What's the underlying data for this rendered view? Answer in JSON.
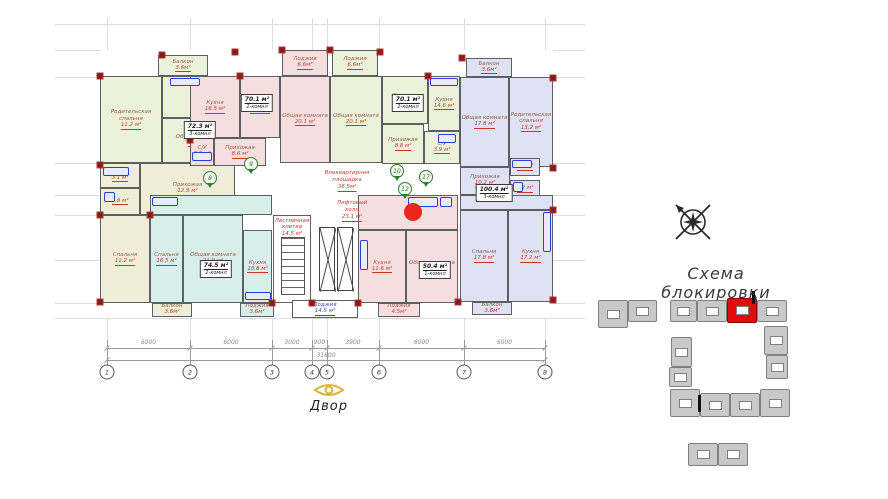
{
  "scheme": {
    "title": "Схема блокировки",
    "blocks": [
      {
        "x": 598,
        "y": 300,
        "w": 30,
        "h": 28,
        "hl": false
      },
      {
        "x": 628,
        "y": 300,
        "w": 29,
        "h": 22,
        "hl": false
      },
      {
        "x": 670,
        "y": 300,
        "w": 27,
        "h": 22,
        "hl": false
      },
      {
        "x": 697,
        "y": 300,
        "w": 30,
        "h": 22,
        "hl": false
      },
      {
        "x": 727,
        "y": 298,
        "w": 30,
        "h": 25,
        "hl": true
      },
      {
        "x": 757,
        "y": 300,
        "w": 30,
        "h": 22,
        "hl": false
      },
      {
        "x": 764,
        "y": 326,
        "w": 24,
        "h": 29,
        "hl": false
      },
      {
        "x": 766,
        "y": 355,
        "w": 22,
        "h": 24,
        "hl": false
      },
      {
        "x": 671,
        "y": 337,
        "w": 21,
        "h": 30,
        "hl": false
      },
      {
        "x": 669,
        "y": 367,
        "w": 23,
        "h": 20,
        "hl": false
      },
      {
        "x": 670,
        "y": 389,
        "w": 30,
        "h": 28,
        "hl": false
      },
      {
        "x": 700,
        "y": 393,
        "w": 30,
        "h": 24,
        "hl": false
      },
      {
        "x": 730,
        "y": 393,
        "w": 30,
        "h": 24,
        "hl": false
      },
      {
        "x": 760,
        "y": 389,
        "w": 30,
        "h": 28,
        "hl": false
      },
      {
        "x": 688,
        "y": 443,
        "w": 30,
        "h": 23,
        "hl": false
      },
      {
        "x": 718,
        "y": 443,
        "w": 30,
        "h": 23,
        "hl": false
      }
    ],
    "marks": [
      {
        "x": 752,
        "y": 291,
        "w": 3,
        "h": 13
      },
      {
        "x": 698,
        "y": 395,
        "w": 3,
        "h": 17
      }
    ]
  },
  "courtyard": {
    "label": "Двор"
  },
  "plan": {
    "palette": {
      "g": "#ecf1d9",
      "y": "#f0eed9",
      "p": "#f7dede",
      "b": "#dee2f3",
      "t": "#d8efe9",
      "w": "#ffffff"
    },
    "footprint": {
      "x": 100,
      "y": 50,
      "w": 453,
      "h": 268
    },
    "grid": {
      "vx": [
        107,
        190,
        272,
        312,
        327,
        379,
        464,
        545
      ],
      "hy": [
        24,
        50,
        77,
        163,
        195,
        215,
        260,
        303,
        318
      ],
      "x1": 55,
      "x2": 585,
      "y1": 18,
      "y2": 345
    },
    "rooms": [
      {
        "id": "balkon-a",
        "x": 158,
        "y": 55,
        "w": 50,
        "h": 21,
        "f": "g",
        "name": "Балкон",
        "area": "3.6м²"
      },
      {
        "id": "roditelskaya-spalnya-a",
        "x": 100,
        "y": 76,
        "w": 62,
        "h": 87,
        "f": "g",
        "name": "Родительская спальня",
        "area": "11.2 м²"
      },
      {
        "id": "kuhnya-a",
        "x": 162,
        "y": 76,
        "w": 73,
        "h": 42,
        "f": "g",
        "name": "Кухня",
        "area": "5.1 м²"
      },
      {
        "id": "obshchaya-komnata-a",
        "x": 162,
        "y": 118,
        "w": 73,
        "h": 45,
        "f": "g",
        "name": "Общая комната",
        "area": "15.6 м²"
      },
      {
        "id": "sanuzel-a1",
        "x": 100,
        "y": 163,
        "w": 40,
        "h": 25,
        "f": "y",
        "name": "С/У",
        "area": "3.1 м²"
      },
      {
        "id": "sanuzel-a2",
        "x": 100,
        "y": 188,
        "w": 40,
        "h": 27,
        "f": "y",
        "name": "",
        "area": "2.9 м²"
      },
      {
        "id": "prihozhaya-a",
        "x": 140,
        "y": 163,
        "w": 95,
        "h": 52,
        "f": "y",
        "name": "Прихожая",
        "area": "12.9 м²"
      },
      {
        "id": "spalnya-a",
        "x": 100,
        "y": 215,
        "w": 50,
        "h": 88,
        "f": "y",
        "name": "Спальня",
        "area": "11.2 м²"
      },
      {
        "id": "balkon-a2",
        "x": 152,
        "y": 303,
        "w": 40,
        "h": 14,
        "f": "y",
        "name": "Балкон",
        "area": "3.6м²"
      },
      {
        "id": "kuhnya-b",
        "x": 190,
        "y": 76,
        "w": 50,
        "h": 62,
        "f": "p",
        "name": "Кухня",
        "area": "16.5 м²"
      },
      {
        "id": "spalnya-b",
        "x": 240,
        "y": 76,
        "w": 40,
        "h": 62,
        "f": "p",
        "name": "Спальня",
        "area": "16.3 м²"
      },
      {
        "id": "lodzhiya-b",
        "x": 282,
        "y": 50,
        "w": 46,
        "h": 26,
        "f": "p",
        "name": "Лоджия",
        "area": "6.6м²"
      },
      {
        "id": "obshchaya-komnata-b",
        "x": 280,
        "y": 76,
        "w": 50,
        "h": 87,
        "f": "p",
        "name": "Общая комната",
        "area": "20.1 м²"
      },
      {
        "id": "sanuzel-b",
        "x": 190,
        "y": 138,
        "w": 24,
        "h": 28,
        "f": "p",
        "name": "С/У",
        "area": "3.5 м²"
      },
      {
        "id": "prihozhaya-b",
        "x": 214,
        "y": 138,
        "w": 52,
        "h": 28,
        "f": "p",
        "name": "Прихожая",
        "area": "8.6 м²"
      },
      {
        "id": "lodzhiya-c",
        "x": 332,
        "y": 50,
        "w": 46,
        "h": 26,
        "f": "g",
        "name": "Лоджия",
        "area": "6.6м²"
      },
      {
        "id": "obshchaya-komnata-c",
        "x": 330,
        "y": 76,
        "w": 52,
        "h": 87,
        "f": "g",
        "name": "Общая комната",
        "area": "20.1 м²"
      },
      {
        "id": "spalnya-c",
        "x": 382,
        "y": 76,
        "w": 46,
        "h": 48,
        "f": "g",
        "name": "Спальня",
        "area": "16.3 м²"
      },
      {
        "id": "kuhnya-c",
        "x": 428,
        "y": 76,
        "w": 32,
        "h": 55,
        "f": "g",
        "name": "Кухня",
        "area": "14.6 м²"
      },
      {
        "id": "prihozhaya-c",
        "x": 382,
        "y": 124,
        "w": 42,
        "h": 40,
        "f": "g",
        "name": "Прихожая",
        "area": "8.8 м²"
      },
      {
        "id": "sanuzel-c",
        "x": 424,
        "y": 131,
        "w": 36,
        "h": 33,
        "f": "g",
        "name": "С/У",
        "area": "3.9 м²"
      },
      {
        "id": "balkon-d",
        "x": 466,
        "y": 58,
        "w": 46,
        "h": 19,
        "f": "b",
        "name": "Балкон",
        "area": "3.6м²"
      },
      {
        "id": "obshchaya-komnata-d",
        "x": 460,
        "y": 77,
        "w": 49,
        "h": 90,
        "f": "b",
        "name": "Общая комната",
        "area": "17.8 м²"
      },
      {
        "id": "roditelskaya-spalnya-d",
        "x": 509,
        "y": 77,
        "w": 44,
        "h": 90,
        "f": "b",
        "name": "Родительская спальня",
        "area": "13.2 м²"
      },
      {
        "id": "prihozhaya-d",
        "x": 460,
        "y": 167,
        "w": 50,
        "h": 28,
        "f": "b",
        "name": "Прихожая",
        "area": "10.2 м²"
      },
      {
        "id": "sanuzel-d1",
        "x": 510,
        "y": 158,
        "w": 30,
        "h": 18,
        "f": "b",
        "name": "",
        "area": "2.2 м²"
      },
      {
        "id": "sanuzel-d2",
        "x": 510,
        "y": 180,
        "w": 30,
        "h": 18,
        "f": "b",
        "name": "",
        "area": "2.2 м²"
      },
      {
        "id": "koridor-d",
        "x": 460,
        "y": 195,
        "w": 93,
        "h": 15,
        "f": "b",
        "name": "",
        "area": ""
      },
      {
        "id": "spalnya-d",
        "x": 460,
        "y": 210,
        "w": 48,
        "h": 92,
        "f": "b",
        "name": "Спальня",
        "area": "17.8 м²"
      },
      {
        "id": "kuhnya-d",
        "x": 508,
        "y": 210,
        "w": 45,
        "h": 92,
        "f": "b",
        "name": "Кухня",
        "area": "17.2 м²"
      },
      {
        "id": "balkon-d2",
        "x": 472,
        "y": 302,
        "w": 40,
        "h": 13,
        "f": "b",
        "name": "Балкон",
        "area": "3.6м²"
      },
      {
        "id": "hall-e",
        "x": 150,
        "y": 195,
        "w": 122,
        "h": 20,
        "f": "t",
        "name": "",
        "area": ""
      },
      {
        "id": "spalnya-e",
        "x": 150,
        "y": 215,
        "w": 33,
        "h": 88,
        "f": "t",
        "name": "Спальня",
        "area": "16.5 м²"
      },
      {
        "id": "obshchaya-komnata-e",
        "x": 183,
        "y": 215,
        "w": 60,
        "h": 88,
        "f": "t",
        "name": "Общая комната",
        "area": "21.9 м²"
      },
      {
        "id": "kuhnya-e",
        "x": 243,
        "y": 230,
        "w": 29,
        "h": 73,
        "f": "t",
        "name": "Кухня",
        "area": "10.8 м²"
      },
      {
        "id": "lodzhiya-e",
        "x": 240,
        "y": 303,
        "w": 34,
        "h": 14,
        "f": "t",
        "name": "Лоджия",
        "area": "3.6м²"
      },
      {
        "id": "lestnichnaya-kletka",
        "x": 273,
        "y": 215,
        "w": 38,
        "h": 88,
        "f": "w",
        "name": "Лестничная клетка",
        "area": "14.5 м²",
        "lc": "red",
        "va": "top"
      },
      {
        "id": "lodzhiya-center",
        "x": 292,
        "y": 300,
        "w": 66,
        "h": 18,
        "f": "w",
        "name": "Лоджия",
        "area": "14.5 м²",
        "lc": "blue"
      },
      {
        "id": "hall-f",
        "x": 358,
        "y": 195,
        "w": 100,
        "h": 35,
        "f": "p",
        "name": "",
        "area": ""
      },
      {
        "id": "kuhnya-f",
        "x": 358,
        "y": 230,
        "w": 48,
        "h": 73,
        "f": "p",
        "name": "Кухня",
        "area": "11.6 м²"
      },
      {
        "id": "obshchaya-komnata-f",
        "x": 406,
        "y": 230,
        "w": 52,
        "h": 73,
        "f": "p",
        "name": "Общая комната",
        "area": "23.0 м²"
      },
      {
        "id": "lodzhiya-f",
        "x": 378,
        "y": 303,
        "w": 42,
        "h": 14,
        "f": "p",
        "name": "Лоджия",
        "area": "4.5м²"
      }
    ],
    "apt_labels": [
      {
        "x": 200,
        "y": 121,
        "area": "72.3 м²",
        "rooms": "3-комнл"
      },
      {
        "x": 257,
        "y": 94,
        "area": "70.1 м²",
        "rooms": "2-комнл"
      },
      {
        "x": 408,
        "y": 94,
        "area": "70.1 м²",
        "rooms": "2-комнл"
      },
      {
        "x": 494,
        "y": 184,
        "area": "100.4 м²",
        "rooms": "3-комнл"
      },
      {
        "x": 216,
        "y": 260,
        "area": "74.5 м²",
        "rooms": "2-комнл"
      },
      {
        "x": 435,
        "y": 261,
        "area": "50.4 м²",
        "rooms": "1-комнл"
      }
    ],
    "red_notes": [
      {
        "x": 347,
        "y": 170,
        "lines": [
          "Внеквартирная",
          "площадка"
        ],
        "value": "36.5м²"
      },
      {
        "x": 352,
        "y": 200,
        "lines": [
          "Лифтовый",
          "холл"
        ],
        "value": "23.1 м²"
      }
    ],
    "pins": [
      {
        "x": 210,
        "y": 178,
        "n": "8"
      },
      {
        "x": 251,
        "y": 164,
        "n": "9"
      },
      {
        "x": 397,
        "y": 171,
        "n": "10"
      },
      {
        "x": 426,
        "y": 177,
        "n": "17"
      },
      {
        "x": 405,
        "y": 189,
        "n": "12"
      }
    ],
    "red_dot": {
      "x": 413,
      "y": 212,
      "d": 18
    },
    "stairs": {
      "x": 281,
      "y": 237,
      "w": 24,
      "h": 58
    },
    "elevators": [
      {
        "x": 319,
        "y": 227,
        "w": 16,
        "h": 64
      },
      {
        "x": 337,
        "y": 227,
        "w": 16,
        "h": 64
      }
    ],
    "columns": [
      [
        100,
        76
      ],
      [
        162,
        55
      ],
      [
        235,
        52
      ],
      [
        282,
        50
      ],
      [
        330,
        50
      ],
      [
        380,
        52
      ],
      [
        428,
        76
      ],
      [
        462,
        58
      ],
      [
        553,
        78
      ],
      [
        100,
        165
      ],
      [
        100,
        215
      ],
      [
        100,
        302
      ],
      [
        553,
        168
      ],
      [
        553,
        210
      ],
      [
        553,
        300
      ],
      [
        272,
        303
      ],
      [
        312,
        303
      ],
      [
        358,
        303
      ],
      [
        458,
        302
      ],
      [
        190,
        140
      ],
      [
        150,
        215
      ],
      [
        240,
        76
      ]
    ],
    "fixtures": [
      {
        "x": 103,
        "y": 167,
        "w": 26,
        "h": 9
      },
      {
        "x": 104,
        "y": 192,
        "w": 11,
        "h": 10
      },
      {
        "x": 192,
        "y": 152,
        "w": 20,
        "h": 9
      },
      {
        "x": 438,
        "y": 134,
        "w": 18,
        "h": 9
      },
      {
        "x": 512,
        "y": 160,
        "w": 20,
        "h": 8
      },
      {
        "x": 513,
        "y": 182,
        "w": 10,
        "h": 10
      },
      {
        "x": 543,
        "y": 212,
        "w": 8,
        "h": 40
      },
      {
        "x": 430,
        "y": 78,
        "w": 28,
        "h": 8
      },
      {
        "x": 170,
        "y": 78,
        "w": 30,
        "h": 8
      },
      {
        "x": 245,
        "y": 292,
        "w": 26,
        "h": 8
      },
      {
        "x": 360,
        "y": 240,
        "w": 8,
        "h": 30
      },
      {
        "x": 408,
        "y": 197,
        "w": 30,
        "h": 10
      },
      {
        "x": 440,
        "y": 197,
        "w": 12,
        "h": 10
      },
      {
        "x": 152,
        "y": 197,
        "w": 26,
        "h": 9
      }
    ]
  },
  "dimensions": {
    "axes": [
      {
        "n": "1",
        "x": 107
      },
      {
        "n": "2",
        "x": 190
      },
      {
        "n": "3",
        "x": 272
      },
      {
        "n": "4",
        "x": 312
      },
      {
        "n": "5",
        "x": 327
      },
      {
        "n": "6",
        "x": 379
      },
      {
        "n": "7",
        "x": 464
      },
      {
        "n": "8",
        "x": 545
      }
    ],
    "segments": [
      {
        "x1": 107,
        "x2": 190,
        "label": "6000"
      },
      {
        "x1": 190,
        "x2": 272,
        "label": "6000"
      },
      {
        "x1": 272,
        "x2": 312,
        "label": "3000"
      },
      {
        "x1": 312,
        "x2": 327,
        "label": "900"
      },
      {
        "x1": 327,
        "x2": 379,
        "label": "3900"
      },
      {
        "x1": 379,
        "x2": 464,
        "label": "6000"
      },
      {
        "x1": 464,
        "x2": 545,
        "label": "6000"
      }
    ],
    "total": {
      "label": "31800",
      "x": 326
    },
    "row1_y": 348,
    "row2_y": 360,
    "circle_y": 372
  }
}
